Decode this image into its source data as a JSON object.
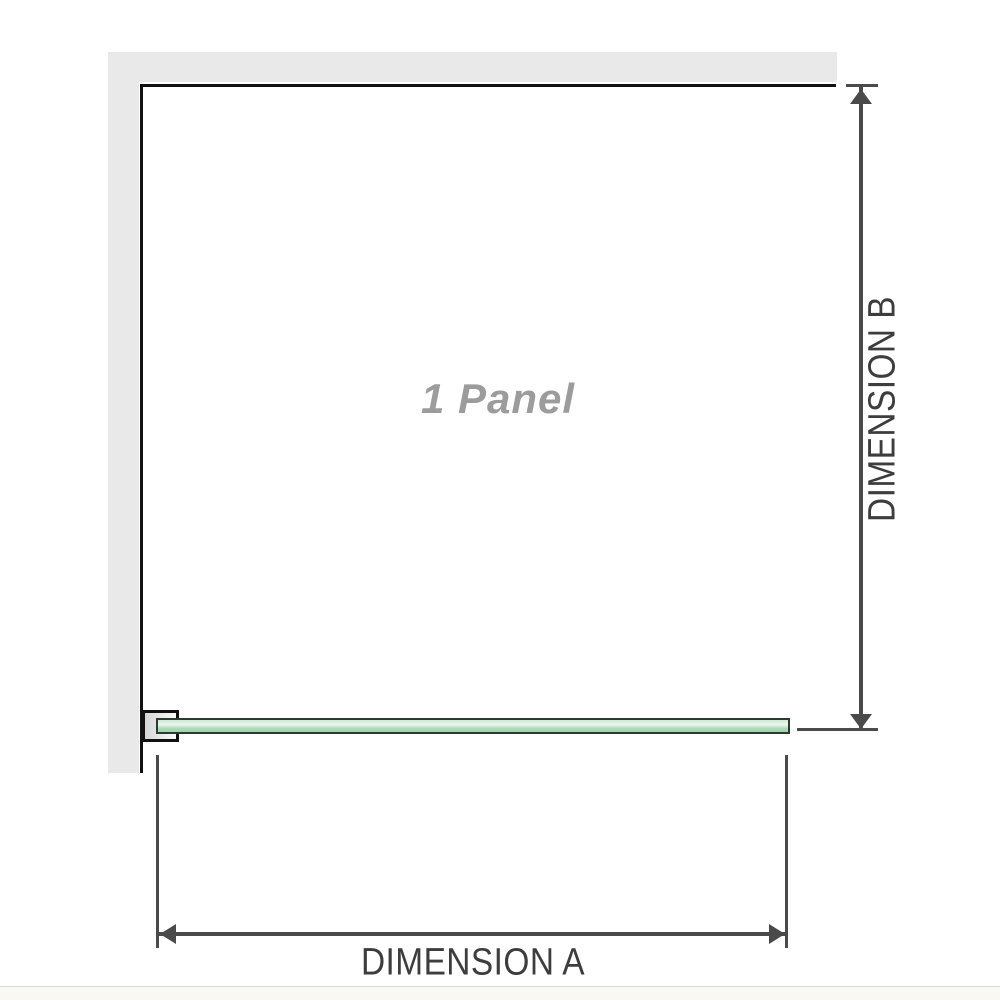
{
  "diagram": {
    "panel_label": "1 Panel",
    "dimension_a_label": "DIMENSION A",
    "dimension_b_label": "DIMENSION B"
  },
  "colors": {
    "wall": "#e9e9e9",
    "outline": "#111111",
    "dimension": "#4a4a4a",
    "label-text": "#3d3d3d",
    "panel-text": "#9c9c9c",
    "glass-border": "#2a3b2f",
    "glass-light": "#cde9d5",
    "glass-highlight": "#edf6ee",
    "glass-mid": "#abd9b8",
    "glass-deep": "#a2d4b1",
    "bottom-line": "#dcdad2",
    "bottom-strip": "#f9f8f2"
  }
}
